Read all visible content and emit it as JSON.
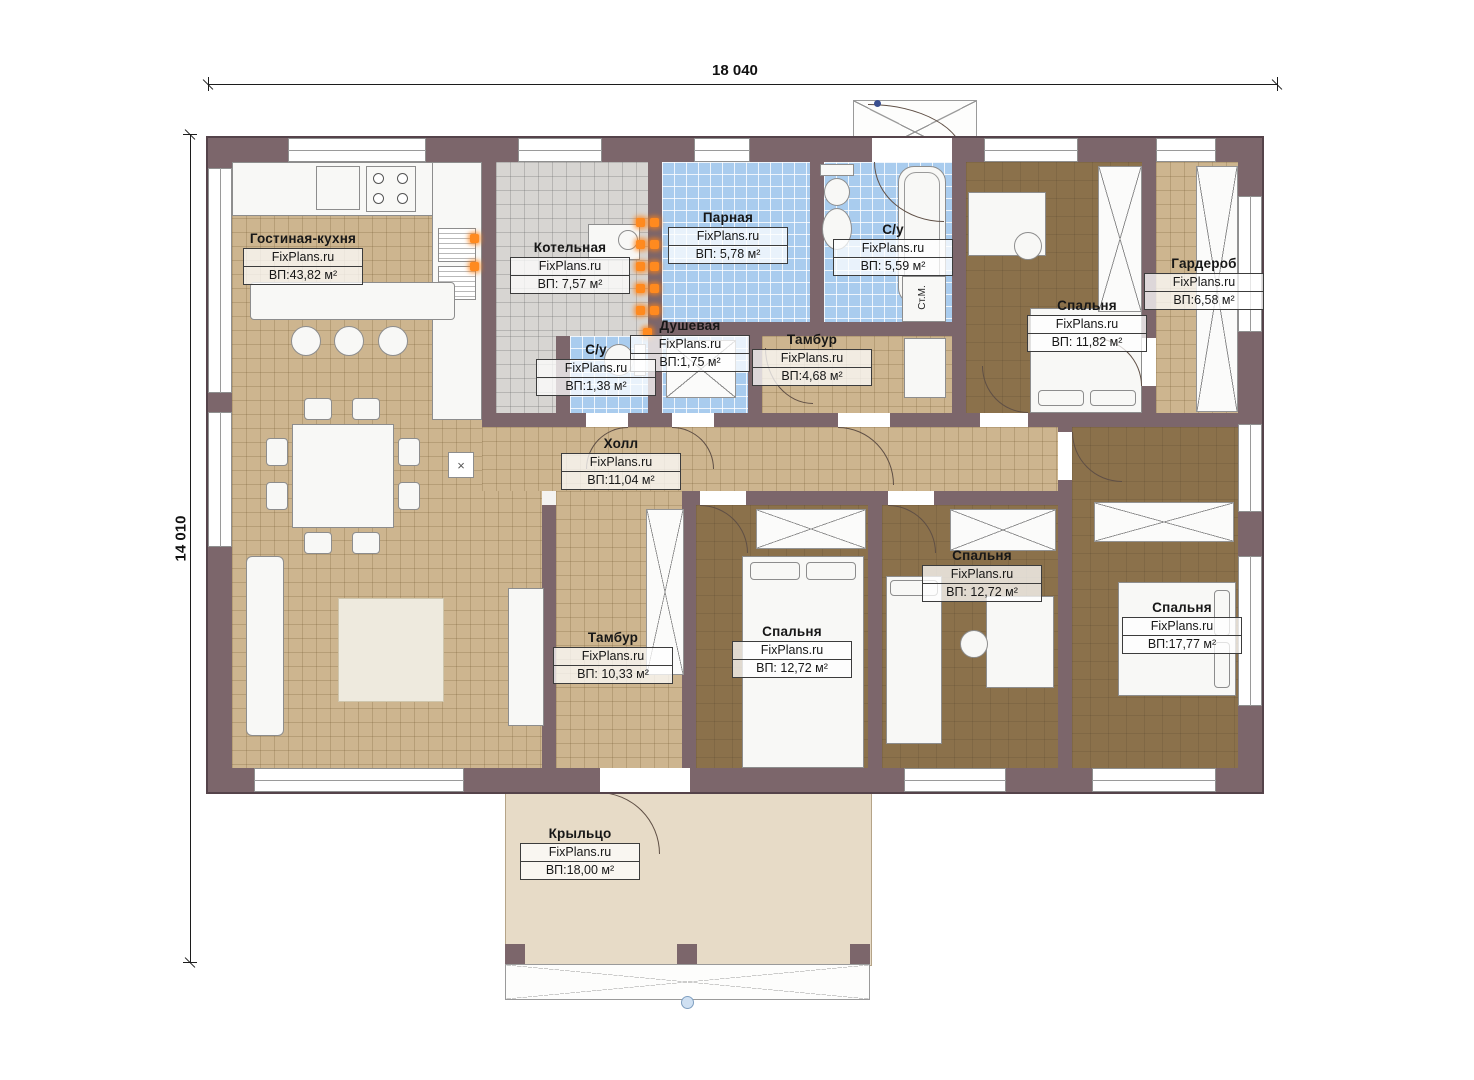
{
  "brand": "FixPlans.ru",
  "dimensions": {
    "width_label": "18 040",
    "height_label": "14 010"
  },
  "appliances": {
    "washing_machine": "Ст.М.",
    "door_marker": "×"
  },
  "rooms": [
    {
      "id": "living",
      "name": "Гостиная-кухня",
      "area": "ВП:43,82 м²"
    },
    {
      "id": "boiler",
      "name": "Котельная",
      "area": "ВП: 7,57 м²"
    },
    {
      "id": "steam",
      "name": "Парная",
      "area": "ВП: 5,78 м²"
    },
    {
      "id": "bath-large",
      "name": "С/у",
      "area": "ВП: 5,59 м²"
    },
    {
      "id": "shower",
      "name": "Душевая",
      "area": "ВП:1,75 м²"
    },
    {
      "id": "bath-small",
      "name": "С/у",
      "area": "ВП:1,38 м²"
    },
    {
      "id": "tambour-top",
      "name": "Тамбур",
      "area": "ВП:4,68 м²"
    },
    {
      "id": "bedroom-ne",
      "name": "Спальня",
      "area": "ВП: 11,82 м²"
    },
    {
      "id": "wardrobe-room",
      "name": "Гардероб",
      "area": "ВП:6,58 м²"
    },
    {
      "id": "hall",
      "name": "Холл",
      "area": "ВП:11,04 м²"
    },
    {
      "id": "tambour-bottom",
      "name": "Тамбур",
      "area": "ВП: 10,33 м²"
    },
    {
      "id": "bedroom-s1",
      "name": "Спальня",
      "area": "ВП: 12,72 м²"
    },
    {
      "id": "bedroom-s2",
      "name": "Спальня",
      "area": "ВП: 12,72 м²"
    },
    {
      "id": "bedroom-se",
      "name": "Спальня",
      "area": "ВП:17,77 м²"
    },
    {
      "id": "porch",
      "name": "Крыльцо",
      "area": "ВП:18,00 м²"
    }
  ]
}
